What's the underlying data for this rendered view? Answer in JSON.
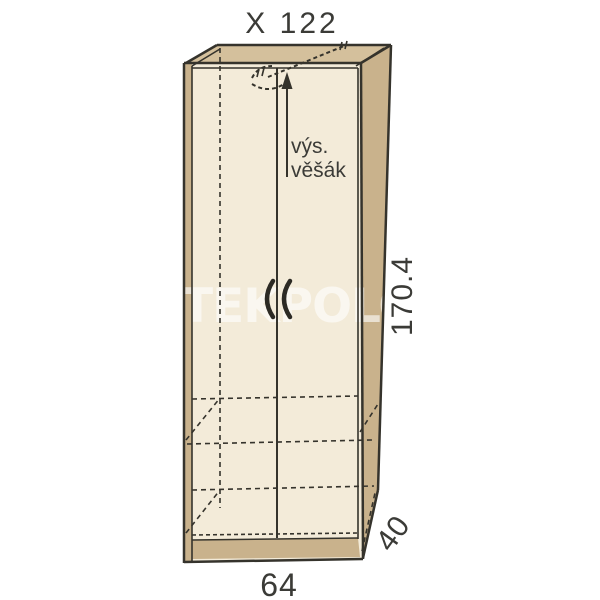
{
  "title": "X 122",
  "watermark": "YTEKPOLOD",
  "dimensions": {
    "height": "170.4",
    "width": "64",
    "depth": "40"
  },
  "annotations": {
    "hanger_line1": "výs.",
    "hanger_line2": "věšák"
  },
  "colors": {
    "front_face": "#f3ebd9",
    "side_face": "#c9b28c",
    "top_face": "#d4c09c",
    "plinth": "#c9b28c",
    "left_edge": "#c9b28c",
    "outline": "#35332c",
    "text": "#3b3b37",
    "watermark": "rgba(255,255,255,0.6)"
  }
}
